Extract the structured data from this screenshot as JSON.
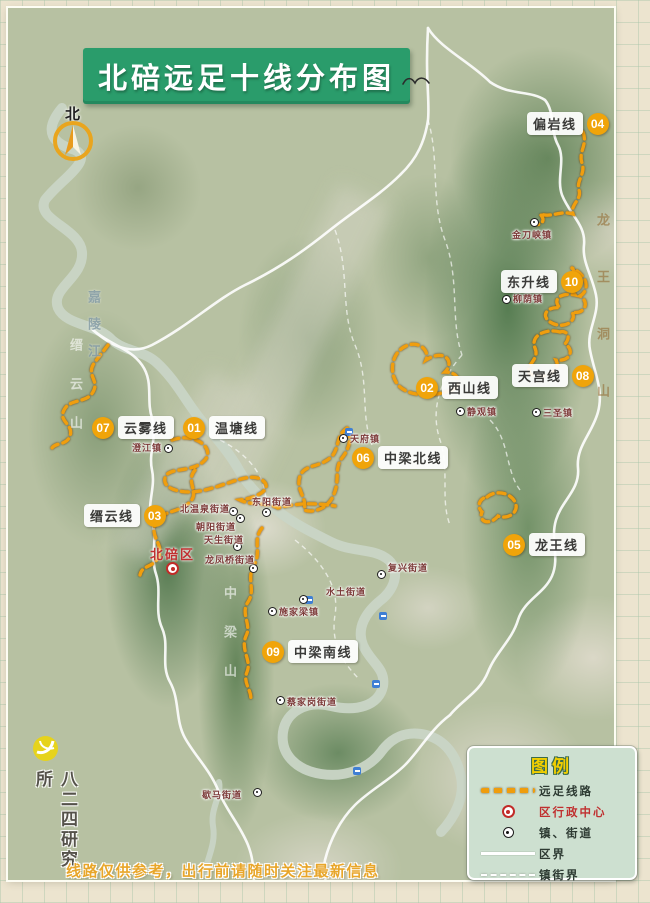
{
  "title": "北碚远足十线分布图",
  "compass_label": "北",
  "trails": [
    {
      "num": "01",
      "name": "温塘线"
    },
    {
      "num": "02",
      "name": "西山线"
    },
    {
      "num": "03",
      "name": "缙云线"
    },
    {
      "num": "04",
      "name": "偏岩线"
    },
    {
      "num": "05",
      "name": "龙王线"
    },
    {
      "num": "06",
      "name": "中梁北线"
    },
    {
      "num": "07",
      "name": "云雾线"
    },
    {
      "num": "08",
      "name": "天宫线"
    },
    {
      "num": "09",
      "name": "中梁南线"
    },
    {
      "num": "10",
      "name": "东升线"
    }
  ],
  "district_center": {
    "name": "北碚区"
  },
  "towns": [
    {
      "name": "金刀峡镇"
    },
    {
      "name": "柳荫镇"
    },
    {
      "name": "三圣镇"
    },
    {
      "name": "静观镇"
    },
    {
      "name": "天府镇"
    },
    {
      "name": "澄江镇"
    },
    {
      "name": "北温泉街道"
    },
    {
      "name": "东阳街道"
    },
    {
      "name": "朝阳街道"
    },
    {
      "name": "天生街道"
    },
    {
      "name": "龙凤桥街道"
    },
    {
      "name": "水土街道"
    },
    {
      "name": "施家梁镇"
    },
    {
      "name": "复兴街道"
    },
    {
      "name": "蔡家岗街道"
    },
    {
      "name": "歇马街道"
    }
  ],
  "terrain_labels": [
    {
      "text": "嘉陵江"
    },
    {
      "text": "缙云山"
    },
    {
      "text": "中梁山"
    },
    {
      "text": "龙王洞山"
    }
  ],
  "legend": {
    "title": "图例",
    "items": [
      {
        "icon": "trail-dash-swatch",
        "label": "远足线路"
      },
      {
        "icon": "district-center-marker",
        "label": "区行政中心"
      },
      {
        "icon": "town-marker",
        "label": "镇、街道"
      },
      {
        "icon": "district-boundary-line",
        "label": "区界"
      },
      {
        "icon": "town-boundary-line",
        "label": "镇街界"
      }
    ]
  },
  "footer_note": "线路仅供参考，出行前请随时关注最新信息",
  "credit": "八二四研究所",
  "colors": {
    "banner_green": "#2a9c6b",
    "trail_orange": "#f0a40a",
    "legend_bg": "#cde0d0",
    "note_yellow": "#e8a62a",
    "district_red": "#c03030",
    "boundary_white": "#ffffff"
  }
}
